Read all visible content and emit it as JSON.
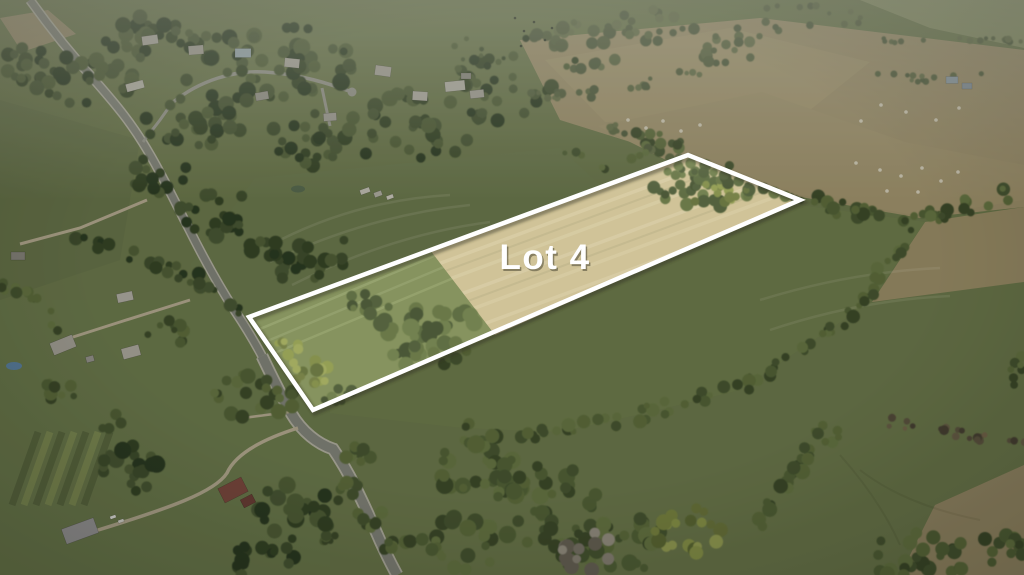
{
  "photo": {
    "type": "aerial-drone-photograph",
    "scene": "Aerial view of rural farmland: a country road with houses on the left, tree lines and pastures, and a highlighted real-estate parcel outlined in white",
    "lot_label": "Lot 4",
    "label_color": "#ffffff",
    "boundary_color": "#ffffff",
    "boundary_width": 4.5,
    "colors": {
      "pasture": "#6d7a4d",
      "hay_field": "#cdbf93",
      "parcel_grass": "#7d8b55",
      "tan_field": "#a2946e",
      "forest": "#3a4a2c",
      "road": "#84867c",
      "road_shoulder": "#b5b3a4",
      "haze": "#d7dacd"
    }
  }
}
